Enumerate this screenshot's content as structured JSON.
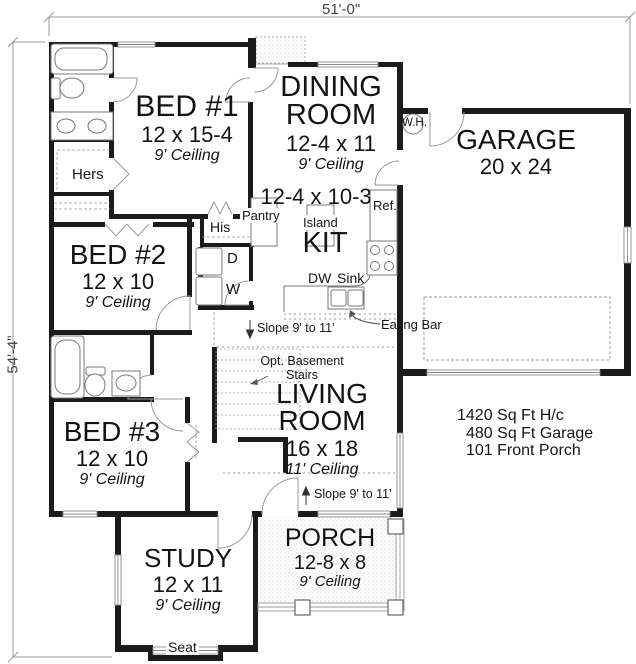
{
  "dimensions": {
    "top": "51'-0\"",
    "left": "54'-4\""
  },
  "rooms": {
    "bed1": {
      "name": "BED #1",
      "size": "12 x 15-4",
      "ceiling": "9' Ceiling"
    },
    "dining": {
      "name": "DINING ROOM",
      "size": "12-4 x 11",
      "ceiling": "9' Ceiling"
    },
    "kitchen": {
      "name": "KIT",
      "size": "12-4 x 10-3"
    },
    "garage": {
      "name": "GARAGE",
      "size": "20 x 24"
    },
    "bed2": {
      "name": "BED #2",
      "size": "12 x 10",
      "ceiling": "9' Ceiling"
    },
    "bed3": {
      "name": "BED #3",
      "size": "12 x 10",
      "ceiling": "9' Ceiling"
    },
    "living": {
      "name": "LIVING ROOM",
      "size": "16 x 18",
      "ceiling": "11' Ceiling"
    },
    "study": {
      "name": "STUDY",
      "size": "12 x 11",
      "ceiling": "9' Ceiling"
    },
    "porch": {
      "name": "PORCH",
      "size": "12-8 x 8",
      "ceiling": "9' Ceiling"
    }
  },
  "labels": {
    "hers": "Hers",
    "his": "His",
    "dryer": "D",
    "washer": "W",
    "pantry": "Pantry",
    "island": "Island",
    "fridge": "Ref.",
    "dishwasher": "DW",
    "sink": "Sink",
    "eating_bar": "Eating Bar",
    "water_heater": "W.H.",
    "slope_upper": "Slope 9' to 11'",
    "slope_lower": "Slope 9' to 11'",
    "opt_basement_line1": "Opt. Basement",
    "opt_basement_line2": "Stairs",
    "seat": "Seat"
  },
  "stats": {
    "line1": "1420 Sq Ft H/c",
    "line2": "480 Sq Ft Garage",
    "line3": "101 Front Porch"
  },
  "colors": {
    "wall": "#1b1b1b",
    "thin_line": "#8a8a8a",
    "text": "#161616",
    "background": "#ffffff"
  }
}
